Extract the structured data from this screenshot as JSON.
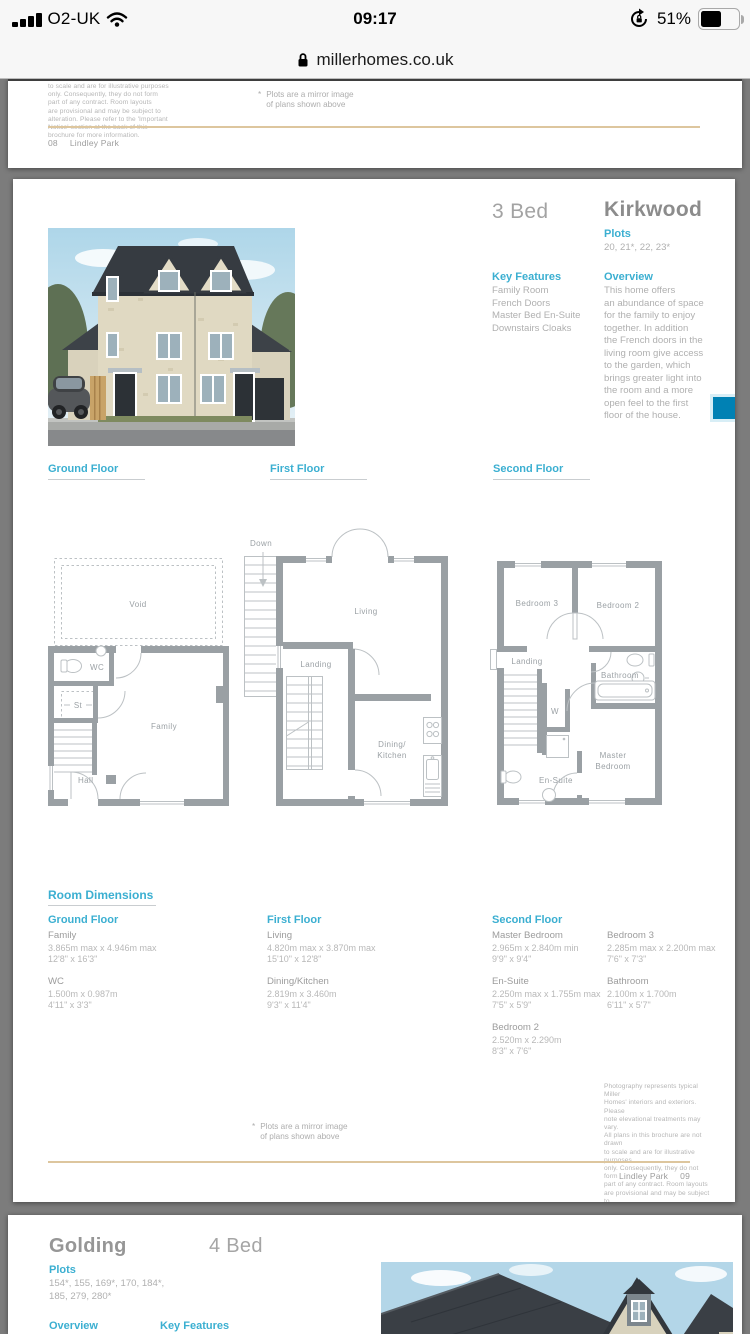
{
  "colors": {
    "accent": "#3bafd1",
    "tab_blue": "#0081b4",
    "rule_tan": "#ddc69e"
  },
  "status_bar": {
    "carrier": "O2-UK",
    "time": "09:17",
    "battery_percent": "51%"
  },
  "url_bar": {
    "domain": "millerhomes.co.uk"
  },
  "page_prev": {
    "disclaimer": "to scale and are for illustrative purposes\nonly. Consequently, they do not form\npart of any contract. Room layouts\nare provisional and may be subject to\nalteration. Please refer to the 'Important\nNotice' section at the back of this\nbrochure for more information.",
    "mirror_star": "*",
    "mirror_note": "Plots are a mirror image\nof plans shown above",
    "footer_page": "08",
    "footer_name": "Lindley Park"
  },
  "page_main": {
    "bed_count": "3 Bed",
    "home_name": "Kirkwood",
    "plots_label": "Plots",
    "plots_values": "20, 21*, 22, 23*",
    "key_features_label": "Key Features",
    "key_features": [
      "Family Room",
      "French Doors",
      "Master Bed En-Suite",
      "Downstairs Cloaks"
    ],
    "overview_label": "Overview",
    "overview_text": "This home offers\nan abundance of space\nfor the family to enjoy\ntogether. In addition\nthe French doors in the\nliving room give access\nto the garden, which\nbrings greater light into\nthe room and a more\nopen feel to the first\nfloor of the house.",
    "plans": {
      "ground": {
        "header": "Ground Floor",
        "void": "Void",
        "wc": "WC",
        "st": "St",
        "family": "Family",
        "hall": "Hall"
      },
      "first": {
        "header": "First Floor",
        "down": "Down",
        "living": "Living",
        "landing": "Landing",
        "dining1": "Dining/",
        "dining2": "Kitchen"
      },
      "second": {
        "header": "Second Floor",
        "bedroom3": "Bedroom 3",
        "bedroom2": "Bedroom 2",
        "landing": "Landing",
        "bathroom": "Bathroom",
        "w": "W",
        "ensuite": "En-Suite",
        "master1": "Master",
        "master2": "Bedroom"
      }
    },
    "room_dimensions": {
      "title": "Room Dimensions",
      "columns": [
        {
          "header": "Ground Floor",
          "entries": [
            {
              "room": "Family",
              "metric": "3.865m max x 4.946m max",
              "imperial": "12'8\" x 16'3\""
            },
            {
              "room": "WC",
              "metric": "1.500m x 0.987m",
              "imperial": "4'11\" x 3'3\""
            }
          ]
        },
        {
          "header": "First Floor",
          "entries": [
            {
              "room": "Living",
              "metric": "4.820m max x 3.870m max",
              "imperial": "15'10\" x 12'8\""
            },
            {
              "room": "Dining/Kitchen",
              "metric": "2.819m x 3.460m",
              "imperial": "9'3\" x 11'4\""
            }
          ]
        },
        {
          "header": "Second Floor",
          "entries": [
            {
              "room": "Master Bedroom",
              "metric": "2.965m x 2.840m min",
              "imperial": "9'9\" x 9'4\""
            },
            {
              "room": "En-Suite",
              "metric": "2.250m max x 1.755m max",
              "imperial": "7'5\" x 5'9\""
            },
            {
              "room": "Bedroom 2",
              "metric": "2.520m x 2.290m",
              "imperial": "8'3\" x 7'6\""
            }
          ]
        },
        {
          "header": "",
          "entries": [
            {
              "room": "Bedroom 3",
              "metric": "2.285m max x 2.200m max",
              "imperial": "7'6\" x 7'3\""
            },
            {
              "room": "Bathroom",
              "metric": "2.100m x 1.700m",
              "imperial": "6'11\" x 5'7\""
            }
          ]
        }
      ]
    },
    "mirror_star": "*",
    "mirror_note": "Plots are a mirror image\nof plans shown above",
    "disclaimer": "Photography represents typical Miller\nHomes' interiors and exteriors. Please\nnote elevational treatments may vary.\nAll plans in this brochure are not drawn\nto scale and are for illustrative purposes\nonly. Consequently, they do not form\npart of any contract. Room layouts\nare provisional and may be subject to\nalteration. Please refer to the 'Important\nNotice' section at the back of this\nbrochure for more information.",
    "footer_name": "Lindley Park",
    "footer_page": "09"
  },
  "page_next": {
    "home_name": "Golding",
    "bed_count": "4 Bed",
    "plots_label": "Plots",
    "plots_values": "154*, 155, 169*, 170, 184*,\n185, 279, 280*",
    "overview_label": "Overview",
    "key_features_label": "Key Features"
  }
}
